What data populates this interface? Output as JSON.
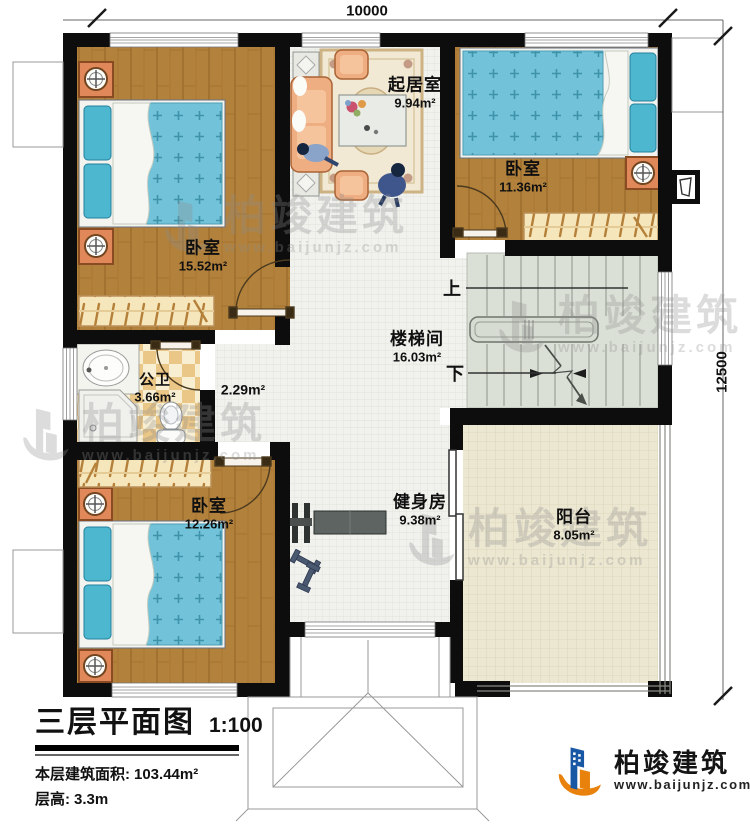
{
  "dimensions": {
    "width_label": "10000",
    "height_label": "12500"
  },
  "rooms": [
    {
      "id": "bedroom-top-left",
      "name": "卧室",
      "area": "15.52m²"
    },
    {
      "id": "living-room",
      "name": "起居室",
      "area": "9.94m²"
    },
    {
      "id": "bedroom-top-right",
      "name": "卧室",
      "area": "11.36m²"
    },
    {
      "id": "stairwell",
      "name": "楼梯间",
      "area": "16.03m²"
    },
    {
      "id": "bathroom",
      "name": "公卫",
      "area": "3.66m²"
    },
    {
      "id": "hallway",
      "name": "",
      "area": "2.29m²"
    },
    {
      "id": "bedroom-bottom-left",
      "name": "卧室",
      "area": "12.26m²"
    },
    {
      "id": "gym",
      "name": "健身房",
      "area": "9.38m²"
    },
    {
      "id": "balcony",
      "name": "阳台",
      "area": "8.05m²"
    }
  ],
  "stairs": {
    "up_label": "上",
    "down_label": "下"
  },
  "title_block": {
    "title": "三层平面图",
    "scale": "1:100",
    "area_label": "本层建筑面积:",
    "area_value": "103.44m²",
    "floor_height_label": "层高:",
    "floor_height_value": "3.3m"
  },
  "brand": {
    "name": "柏竣建筑",
    "website": "www.baijunjz.com"
  },
  "watermark": {
    "name": "柏竣建筑",
    "website": "www.baijunjz.com"
  },
  "colors": {
    "wall": "#0d0d0d",
    "wood_floor": "#b2813c",
    "tile_floor": "#eac687",
    "mattress_blue": "#72c3d9",
    "stair_floor": "#dbe0d6",
    "balcony_floor": "#ece7d1",
    "sofa_peach": "#efad82",
    "accent_orange": "#e8820c",
    "accent_blue": "#1857a4"
  }
}
